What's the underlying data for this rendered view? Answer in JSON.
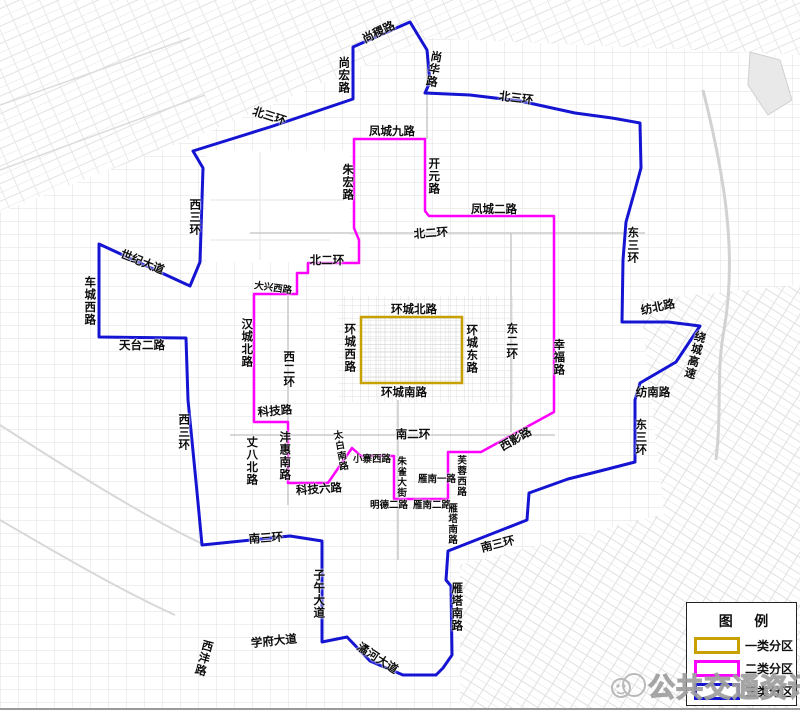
{
  "legend": {
    "title": "图 例",
    "items": [
      {
        "label": "一类分区",
        "color": "#C8A000"
      },
      {
        "label": "二类分区",
        "color": "#FF00FF"
      },
      {
        "label": "三类分区",
        "color": "#1414D2"
      }
    ]
  },
  "watermark": {
    "text": "公共交通资讯"
  },
  "map": {
    "boundaries": {
      "class1": {
        "x": 361,
        "y": 317,
        "w": 101,
        "h": 66,
        "color": "#C8A000"
      },
      "class2": {
        "color": "#FF00FF",
        "points": [
          [
            354,
            139
          ],
          [
            425,
            139
          ],
          [
            425,
            211
          ],
          [
            429,
            216
          ],
          [
            554,
            216
          ],
          [
            554,
            412
          ],
          [
            481,
            452
          ],
          [
            448,
            452
          ],
          [
            448,
            499
          ],
          [
            394,
            499
          ],
          [
            394,
            456
          ],
          [
            361,
            456
          ],
          [
            352,
            448
          ],
          [
            328,
            483
          ],
          [
            288,
            483
          ],
          [
            288,
            422
          ],
          [
            254,
            422
          ],
          [
            254,
            294
          ],
          [
            297,
            294
          ],
          [
            297,
            273
          ],
          [
            308,
            273
          ],
          [
            308,
            263
          ],
          [
            359,
            263
          ],
          [
            359,
            240
          ],
          [
            354,
            228
          ]
        ]
      },
      "class3": {
        "color": "#1414D2",
        "points": [
          [
            410,
            22
          ],
          [
            427,
            50
          ],
          [
            430,
            82
          ],
          [
            425,
            93
          ],
          [
            470,
            95
          ],
          [
            520,
            101
          ],
          [
            575,
            113
          ],
          [
            612,
            118
          ],
          [
            640,
            123
          ],
          [
            641,
            168
          ],
          [
            635,
            190
          ],
          [
            626,
            222
          ],
          [
            623,
            260
          ],
          [
            622,
            322
          ],
          [
            668,
            322
          ],
          [
            700,
            326
          ],
          [
            676,
            362
          ],
          [
            640,
            383
          ],
          [
            635,
            400
          ],
          [
            635,
            462
          ],
          [
            600,
            471
          ],
          [
            568,
            479
          ],
          [
            529,
            493
          ],
          [
            527,
            520
          ],
          [
            448,
            551
          ],
          [
            446,
            580
          ],
          [
            451,
            586
          ],
          [
            452,
            655
          ],
          [
            443,
            668
          ],
          [
            436,
            675
          ],
          [
            403,
            675
          ],
          [
            370,
            661
          ],
          [
            347,
            637
          ],
          [
            322,
            642
          ],
          [
            322,
            541
          ],
          [
            290,
            536
          ],
          [
            202,
            545
          ],
          [
            197,
            492
          ],
          [
            188,
            400
          ],
          [
            186,
            338
          ],
          [
            99,
            337
          ],
          [
            99,
            244
          ],
          [
            190,
            286
          ],
          [
            200,
            262
          ],
          [
            203,
            168
          ],
          [
            193,
            151
          ],
          [
            270,
            127
          ],
          [
            353,
            99
          ],
          [
            353,
            47
          ]
        ]
      }
    },
    "labels": [
      {
        "text": "尚稷路",
        "x": 379,
        "y": 33,
        "rot": -26
      },
      {
        "text": "尚宏路",
        "x": 343,
        "y": 75,
        "v": 1
      },
      {
        "text": "尚华路",
        "x": 433,
        "y": 69,
        "v": 1,
        "rot": 10
      },
      {
        "text": "北三环",
        "x": 269,
        "y": 117,
        "rot": 18
      },
      {
        "text": "北三环",
        "x": 516,
        "y": 99,
        "rot": 7
      },
      {
        "text": "凤城九路",
        "x": 392,
        "y": 132
      },
      {
        "text": "朱宏路",
        "x": 347,
        "y": 182,
        "v": 1
      },
      {
        "text": "开元路",
        "x": 433,
        "y": 176,
        "v": 1
      },
      {
        "text": "凤城二路",
        "x": 494,
        "y": 210
      },
      {
        "text": "北二环",
        "x": 431,
        "y": 234,
        "rot": -4
      },
      {
        "text": "北二环",
        "x": 327,
        "y": 261
      },
      {
        "text": "西三环",
        "x": 194,
        "y": 217,
        "v": 1
      },
      {
        "text": "世纪大道",
        "x": 142,
        "y": 263,
        "rot": 22
      },
      {
        "text": "车城西路",
        "x": 89,
        "y": 301,
        "v": 1
      },
      {
        "text": "天台二路",
        "x": 142,
        "y": 346
      },
      {
        "text": "汉城北路",
        "x": 246,
        "y": 343,
        "v": 1
      },
      {
        "text": "大兴西路",
        "x": 273,
        "y": 289,
        "rot": 8,
        "s": 1
      },
      {
        "text": "西二环",
        "x": 288,
        "y": 369,
        "v": 1
      },
      {
        "text": "环城北路",
        "x": 414,
        "y": 310
      },
      {
        "text": "环城西路",
        "x": 349,
        "y": 348,
        "v": 1
      },
      {
        "text": "环城东路",
        "x": 471,
        "y": 349,
        "v": 1
      },
      {
        "text": "环城南路",
        "x": 404,
        "y": 393
      },
      {
        "text": "东二环",
        "x": 511,
        "y": 341,
        "v": 1
      },
      {
        "text": "幸福路",
        "x": 558,
        "y": 357,
        "v": 1
      },
      {
        "text": "东三环",
        "x": 632,
        "y": 245,
        "v": 1
      },
      {
        "text": "纺北路",
        "x": 658,
        "y": 308,
        "rot": -12
      },
      {
        "text": "绕城高速",
        "x": 694,
        "y": 355,
        "v": 1,
        "rot": 15
      },
      {
        "text": "纺南路",
        "x": 653,
        "y": 393
      },
      {
        "text": "东三环",
        "x": 640,
        "y": 437,
        "v": 1
      },
      {
        "text": "西三环",
        "x": 183,
        "y": 432,
        "v": 1
      },
      {
        "text": "科技路",
        "x": 275,
        "y": 412,
        "rot": -5
      },
      {
        "text": "丈八北路",
        "x": 251,
        "y": 461,
        "v": 1
      },
      {
        "text": "沣惠南路",
        "x": 284,
        "y": 456,
        "v": 1
      },
      {
        "text": "科技六路",
        "x": 319,
        "y": 490,
        "rot": -4
      },
      {
        "text": "太白南路",
        "x": 339,
        "y": 451,
        "v": 1,
        "rot": -10,
        "s": 1
      },
      {
        "text": "小寨西路",
        "x": 372,
        "y": 460,
        "s": 1
      },
      {
        "text": "朱雀大街",
        "x": 400,
        "y": 477,
        "v": 1,
        "s": 1
      },
      {
        "text": "明德二路",
        "x": 389,
        "y": 506,
        "s": 1
      },
      {
        "text": "雁南二路",
        "x": 432,
        "y": 506,
        "s": 1
      },
      {
        "text": "雁南一路",
        "x": 437,
        "y": 480,
        "s": 1
      },
      {
        "text": "芙蓉西路",
        "x": 460,
        "y": 476,
        "v": 1,
        "s": 1
      },
      {
        "text": "西影路",
        "x": 516,
        "y": 440,
        "rot": -30
      },
      {
        "text": "南二环",
        "x": 413,
        "y": 435
      },
      {
        "text": "雁塔南路",
        "x": 451,
        "y": 524,
        "v": 1,
        "s": 1
      },
      {
        "text": "雁塔南路",
        "x": 456,
        "y": 607,
        "v": 1
      },
      {
        "text": "南三环",
        "x": 266,
        "y": 539,
        "rot": -4
      },
      {
        "text": "南三环",
        "x": 498,
        "y": 545,
        "rot": -14
      },
      {
        "text": "子午大道",
        "x": 318,
        "y": 594,
        "v": 1
      },
      {
        "text": "潏河大道",
        "x": 377,
        "y": 659,
        "rot": 33
      },
      {
        "text": "学府大道",
        "x": 274,
        "y": 642,
        "rot": -6
      },
      {
        "text": "西沣路",
        "x": 203,
        "y": 658,
        "v": 1,
        "rot": 15
      }
    ]
  }
}
